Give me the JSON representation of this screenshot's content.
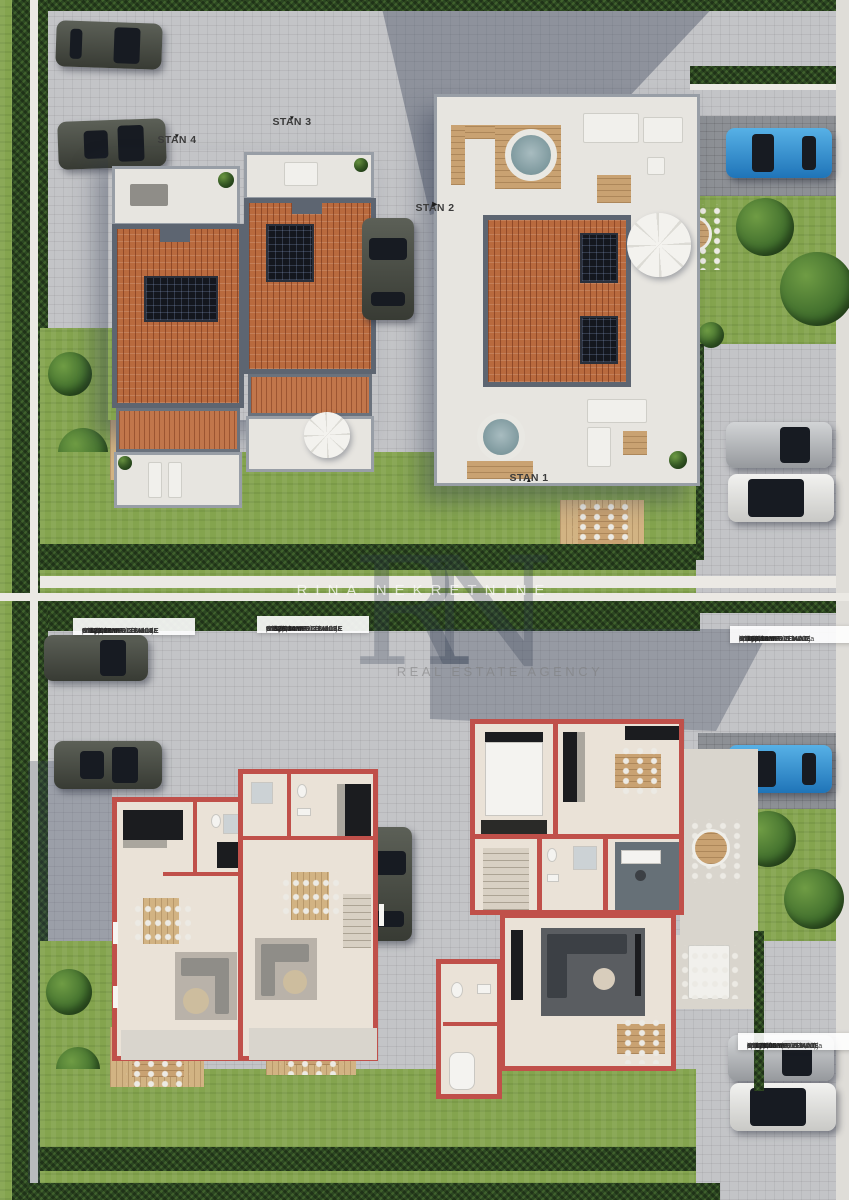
{
  "watermark": {
    "monogram": "RN",
    "title": "RINA NEKRETNINE",
    "subtitle": "REAL ESTATE AGENCY"
  },
  "site_labels": {
    "stan4": {
      "text": "STAN 4",
      "arrow": "▼"
    },
    "stan3": {
      "text": "STAN 3",
      "arrow": "▼"
    },
    "stan2": {
      "text": "STAN 2",
      "arrow": "▶"
    },
    "stan1": {
      "text": "STAN 1",
      "arrow": "▲"
    }
  },
  "tables": [
    {
      "id": "stan4",
      "title": "STAN 4 - PRIZEMLJE",
      "rows": [
        {
          "label": "dnevni boravak i kuhinja",
          "value": "38,60 m²"
        },
        {
          "label": "pretprostor",
          "value": "3,10 m²"
        },
        {
          "label": "wc",
          "value": "1,92 m²"
        },
        {
          "label": "stubište",
          "value": "3,70 m²"
        },
        {
          "label": "utility",
          "value": "2,73 m²"
        }
      ],
      "subtotal": {
        "label": "UKUPNO PRIZEMLJE",
        "value": "50,05 m²"
      },
      "extra": null,
      "total": {
        "label": "SVEUKUPNO STAN 4",
        "value": "122,27 m²"
      }
    },
    {
      "id": "stan3",
      "title": "STAN 3 - PRIZEMLJE",
      "rows": [
        {
          "label": "dnevni boravak i kuhinja",
          "value": "38,60 m²"
        },
        {
          "label": "pretprostor",
          "value": "3,10 m²"
        },
        {
          "label": "wc",
          "value": "1,92 m²"
        },
        {
          "label": "stubište",
          "value": "3,70 m²"
        },
        {
          "label": "utility",
          "value": "3,26 m²"
        }
      ],
      "subtotal": {
        "label": "UKUPNO PRIZEMLJE",
        "value": "53,31 m²"
      },
      "extra": null,
      "total": {
        "label": "SVEUKUPNO STAN 3",
        "value": "126,34 m²"
      }
    },
    {
      "id": "stan2",
      "title": "STAN 2 - PRVI KAT",
      "rows": [
        {
          "label": "dnevni boravak i kuhinja",
          "value": "41,84 m²"
        },
        {
          "label": "pretprostor",
          "value": "5,83 m²"
        },
        {
          "label": "soba 1",
          "value": "11,23 m²"
        },
        {
          "label": "kupaona 1",
          "value": "3,63 m²"
        },
        {
          "label": "stubište",
          "value": "2,43 m²"
        },
        {
          "label": "utility",
          "value": "3,31 m²"
        },
        {
          "label": "spremište",
          "value": "2,68 m²"
        }
      ],
      "subtotal": {
        "label": "UKUPNO PRIZEMLJE",
        "value": "70,95 m²"
      },
      "extra": null,
      "total": {
        "label": "SVEUKUPNO STAN 2",
        "value": "168,18 m²"
      }
    },
    {
      "id": "stan1",
      "title": "STAN 1 - PRVI KAT",
      "rows": [
        {
          "label": "dnevni boravak i kuhinja",
          "value": "38,70 m²"
        },
        {
          "label": "pretprostor",
          "value": "8,57 m²"
        },
        {
          "label": "soba 1",
          "value": "10,47 m²"
        },
        {
          "label": "kupaona 1",
          "value": "3,59 m²"
        },
        {
          "label": "stubište",
          "value": "2,43 m²"
        },
        {
          "label": "utility",
          "value": "3,76 m²"
        },
        {
          "label": "spremište 1",
          "value": "2,68 m²"
        },
        {
          "label": "spremište  2",
          "value": "3,20 m²"
        }
      ],
      "subtotal": {
        "label": "UKUPNO PRIZEMLJE",
        "value": "73,4"
      },
      "extra": {
        "label": "natkr. ulaz  (2,06x0,75)",
        "value": "1,55"
      },
      "total": {
        "label": "SVEUKUPNO STAN 1",
        "value": "171,05 m²"
      }
    }
  ],
  "colors": {
    "roof_terracotta": "#b96a3e",
    "plan_wall_red": "#c0504a",
    "lawn_green": "#84a44e",
    "hedge_green": "#2c4722",
    "car_blue": "#2e8fd4"
  }
}
